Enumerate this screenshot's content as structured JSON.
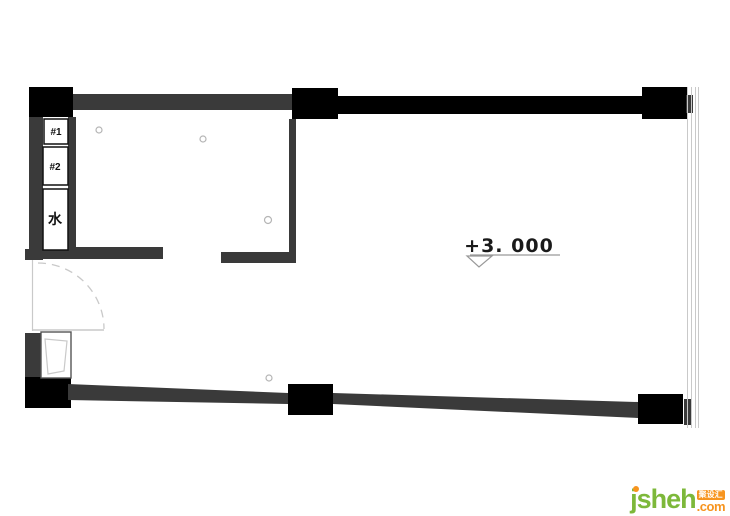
{
  "canvas": {
    "width": 730,
    "height": 516,
    "background": "#ffffff"
  },
  "floor_plan": {
    "compartments": [
      {
        "label": "#1"
      },
      {
        "label": "#2"
      },
      {
        "label": "水"
      }
    ],
    "elevation_marker": {
      "label": "+3. 000"
    },
    "colors": {
      "column": "#000000",
      "wall": "#3a3a3a",
      "thin_line": "#c9c9c9",
      "box_border": "#111111",
      "annotation": "#1a1a1a",
      "marker_line": "#999999"
    }
  },
  "watermark": {
    "brand": "jsheh",
    "badge_text": "聚设汇",
    "suffix": ".com",
    "colors": {
      "green": "#7db83a",
      "orange": "#f7941e"
    }
  }
}
